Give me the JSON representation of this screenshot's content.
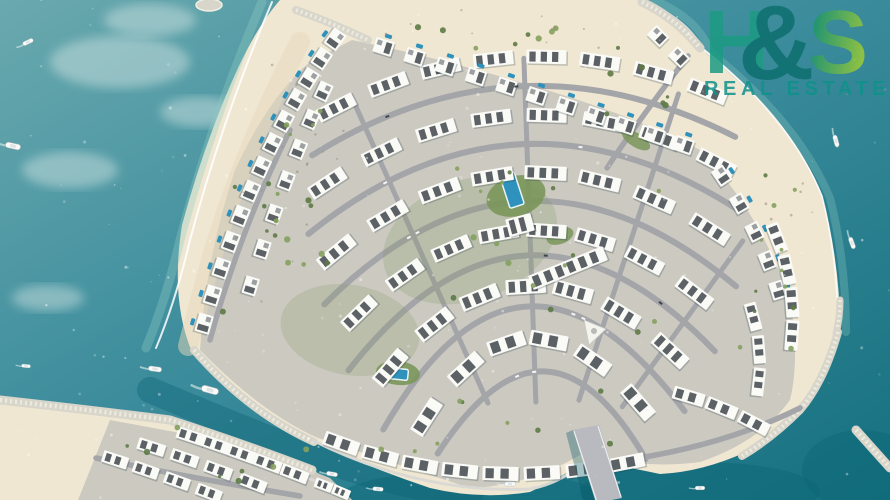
{
  "watermark": {
    "h": "H",
    "amp": "&",
    "s": "S",
    "subtitle": "REAL ESTATE",
    "colors": {
      "h": "#1c9b82",
      "amp": "#0d6f6e",
      "s_from": "#17936c",
      "s_to": "#9ccb37",
      "subtitle": "#0f928a"
    }
  },
  "scene": {
    "w": 890,
    "h": 500,
    "seed": 97,
    "fan_center": [
      540,
      520
    ],
    "colors": {
      "water_top": "#6aa9ae",
      "water_mid": "#3d8d9d",
      "water_deep": "#15707f",
      "channel": "#0c6575",
      "milky": "#e8f2ee",
      "sand": "#f0e7d2",
      "sand_shade": "#e6dabc",
      "pavement": "#cbc9c0",
      "road": "#a4a5a9",
      "promenade": "#d9d8d3",
      "rock": "#d8d5ca",
      "rock_light": "#f1eee4",
      "wall": "#fafaf7",
      "roof": "#3e454a",
      "shadow": "#223a44",
      "pool": "#2f92bc",
      "pool_edge": "#e8f4f6",
      "green_dark": "#5d7a45",
      "green_light": "#85a05e",
      "lawn": "#7b965a",
      "foam": "#ffffff",
      "shallow": "#8ecac3",
      "speck": "#90856f",
      "car_light": "#f5f5f5",
      "car_dark": "#3e454a",
      "boat_hull": "#fbfbf9",
      "boat_deck": "#dfe5e6",
      "boat_edge": "#9fb0b4",
      "wake": "#dff0ee",
      "bridge_deck": "#b9bac0",
      "bridge_rail": "#eceff0",
      "bridge_shadow": "#0a5864",
      "plaza": "#f4f3ee",
      "plaza_edge": "#c9c9c4",
      "plaza_dot": "#b9bab6"
    },
    "deep_ellipses": [
      [
        470,
        497,
        130,
        26
      ],
      [
        700,
        492,
        120,
        30
      ],
      [
        862,
        470,
        60,
        40
      ]
    ],
    "channel_strokes": [
      "M150,390 Q250,432 330,462 Q400,486 470,496"
    ],
    "milky_patches": [
      [
        120,
        62,
        70,
        26
      ],
      [
        70,
        170,
        48,
        18
      ],
      [
        200,
        112,
        40,
        15
      ],
      [
        48,
        298,
        36,
        13
      ],
      [
        150,
        20,
        46,
        16
      ]
    ],
    "landmasses": [
      {
        "name": "south-island-sand",
        "fill": "sand",
        "d": "M0,398 L30,402 Q100,412 170,420 Q240,444 300,464 Q335,480 352,500 L0,500 Z"
      },
      {
        "name": "south-island-pavement",
        "fill": "pavement",
        "d": "M110,420 L250,446 L330,478 L352,500 L78,500 Z"
      },
      {
        "name": "main-island-sand",
        "fill": "sand",
        "d": "M280,0 L645,0 Q680,20 700,46 Q790,115 822,195 Q840,262 840,330 Q828,372 806,404 Q782,430 746,452 Q702,472 660,474 Q622,466 588,460 Q560,478 530,492 Q480,500 430,488 Q370,468 314,442 Q250,414 192,352 Q170,300 182,225 Q205,140 238,68 Q258,25 280,0 Z"
      },
      {
        "name": "main-island-pavement",
        "fill": "pavement",
        "d": "M352,40 Q440,58 540,88 Q640,118 700,150 Q760,212 790,300 Q800,360 790,400 Q760,442 700,462 Q640,470 585,452 Q530,486 470,488 Q390,462 318,438 Q260,412 200,350 Q205,260 235,170 Q270,95 310,62 Z"
      }
    ],
    "beach_shade": {
      "d": "M300,42 Q248,140 214,250 Q200,300 188,346",
      "color": "#e6dabc",
      "wd": 20,
      "op": 0.5
    },
    "foam": [
      {
        "d": "M262,2 Q212,120 180,240 Q166,300 146,348",
        "color": "#8ecac3",
        "wd": 9,
        "op": 0.35
      },
      {
        "d": "M272,2 Q222,120 190,240 Q176,300 156,348",
        "color": "#ffffff",
        "wd": 2,
        "op": 0.85
      },
      {
        "d": "M654,0 Q700,20 710,52 Q798,122 830,198 Q846,262 846,332",
        "color": "#8ecac3",
        "wd": 8,
        "op": 0.3
      },
      {
        "d": "M648,2 Q690,22 702,48 Q790,118 822,196 Q838,260 838,330",
        "color": "#ffffff",
        "wd": 1.6,
        "op": 0.8
      }
    ],
    "rocks": [
      {
        "d": "M296,10 Q330,22 368,40",
        "wd": 8
      },
      {
        "d": "M642,2 Q676,18 700,48",
        "wd": 9
      },
      {
        "d": "M840,300 Q840,318 836,334",
        "wd": 7
      },
      {
        "d": "M838,332 Q824,382 800,410 Q772,438 742,456",
        "wd": 8
      },
      {
        "d": "M856,430 L890,468",
        "wd": 9
      },
      {
        "d": "M194,350 Q248,412 314,442",
        "wd": 8
      },
      {
        "d": "M0,400 Q90,410 170,420 Q250,446 312,470",
        "wd": 9
      }
    ],
    "roads": {
      "rings": [
        [
          430,
          238,
          297
        ],
        [
          368,
          231,
          303
        ],
        [
          305,
          225,
          310
        ],
        [
          243,
          218,
          316
        ],
        [
          181,
          210,
          323
        ],
        [
          122,
          213,
          330
        ]
      ],
      "spokes": [
        [
          246,
          128,
          452
        ],
        [
          268,
          118,
          462
        ],
        [
          288,
          126,
          448
        ],
        [
          306,
          140,
          345
        ]
      ],
      "extra": [
        "M688,56 Q640,118 607,168",
        "M612,462 Q720,448 800,408",
        "M96,458 Q180,476 300,496",
        "M210,340 Q240,230 290,130"
      ]
    },
    "cars": {
      "n": 12
    },
    "promenades": [
      "M312,440 Q420,494 530,489 Q562,483 588,459",
      "M178,430 Q250,455 318,482"
    ],
    "parks": [
      [
        516,
        196,
        30,
        20,
        -15,
        0.9
      ],
      [
        398,
        373,
        22,
        12,
        6,
        0.9
      ],
      [
        636,
        140,
        16,
        7,
        32,
        0.85
      ],
      [
        560,
        236,
        14,
        8,
        -20,
        0.85
      ],
      [
        470,
        240,
        90,
        60,
        -20,
        0.22
      ],
      [
        350,
        330,
        70,
        45,
        10,
        0.2
      ]
    ],
    "pools": [
      [
        512,
        190,
        15,
        34,
        -18
      ],
      [
        398,
        374,
        20,
        11,
        6
      ]
    ],
    "plaza": {
      "tri": "M584,320 L606,329 L589,345 Z",
      "dot": [
        594,
        331,
        3
      ]
    },
    "rows": [
      {
        "kind": "ring",
        "r": 460,
        "a0": 240,
        "a1": 295,
        "count": 8,
        "type": "block",
        "w": 40,
        "h": 14
      },
      {
        "kind": "ring",
        "r": 398,
        "a0": 233,
        "a1": 301,
        "count": 8,
        "type": "block",
        "w": 40,
        "h": 14
      },
      {
        "kind": "ring",
        "r": 336,
        "a0": 227,
        "a1": 306,
        "count": 8,
        "type": "block",
        "w": 42,
        "h": 14
      },
      {
        "kind": "ring",
        "r": 274,
        "a0": 222,
        "a1": 311,
        "count": 8,
        "type": "block",
        "w": 40,
        "h": 14
      },
      {
        "kind": "ring",
        "r": 212,
        "a0": 216,
        "a1": 317,
        "count": 7,
        "type": "block",
        "w": 40,
        "h": 15
      },
      {
        "kind": "ring",
        "r": 150,
        "a0": 208,
        "a1": 324,
        "count": 6,
        "type": "block",
        "w": 38,
        "h": 15
      },
      {
        "kind": "quad",
        "p": [
          342,
          30,
          252,
          150,
          200,
          338
        ],
        "count": 13,
        "type": "villa",
        "w": 19,
        "h": 15,
        "pool": 1
      },
      {
        "kind": "quad",
        "p": [
          330,
          78,
          285,
          170,
          245,
          305
        ],
        "count": 7,
        "type": "villa",
        "w": 18,
        "h": 14,
        "pool": 0
      },
      {
        "kind": "quad",
        "p": [
          368,
          42,
          540,
          96,
          698,
          150
        ],
        "count": 11,
        "type": "villa",
        "w": 19,
        "h": 15,
        "pool": -1
      },
      {
        "kind": "quad",
        "p": [
          712,
          162,
          762,
          230,
          782,
          305
        ],
        "count": 5,
        "type": "villa",
        "w": 18,
        "h": 14,
        "pool": -1
      },
      {
        "kind": "quad",
        "p": [
          648,
          26,
          668,
          46,
          690,
          68
        ],
        "count": 2,
        "type": "villa",
        "w": 18,
        "h": 14,
        "pool": 0
      },
      {
        "kind": "quad",
        "p": [
          322,
          436,
          475,
          498,
          648,
          458
        ],
        "count": 8,
        "type": "block",
        "w": 36,
        "h": 14
      },
      {
        "kind": "quad",
        "p": [
          672,
          392,
          722,
          404,
          770,
          432
        ],
        "count": 3,
        "type": "block",
        "w": 32,
        "h": 13
      },
      {
        "kind": "quad",
        "p": [
          770,
          222,
          800,
          285,
          790,
          352
        ],
        "count": 4,
        "type": "block",
        "w": 30,
        "h": 13
      },
      {
        "kind": "quad",
        "p": [
          748,
          300,
          766,
          350,
          756,
          398
        ],
        "count": 3,
        "type": "block",
        "w": 28,
        "h": 12
      },
      {
        "kind": "quad",
        "p": [
          178,
          432,
          240,
          452,
          308,
          479
        ],
        "count": 5,
        "type": "block",
        "w": 28,
        "h": 12
      },
      {
        "kind": "quad",
        "p": [
          135,
          442,
          200,
          462,
          270,
          490
        ],
        "count": 4,
        "type": "block",
        "w": 28,
        "h": 12
      },
      {
        "kind": "quad",
        "p": [
          100,
          455,
          160,
          474,
          225,
          499
        ],
        "count": 4,
        "type": "block",
        "w": 26,
        "h": 12
      },
      {
        "kind": "quad",
        "p": [
          315,
          482,
          332,
          488,
          350,
          496
        ],
        "count": 2,
        "type": "block",
        "w": 18,
        "h": 10
      }
    ],
    "extra_blocks": [
      [
        568,
        268,
        80,
        15,
        -22,
        6
      ],
      [
        520,
        225,
        26,
        18,
        -15,
        2
      ]
    ],
    "tree_zones": [
      [
        220,
        90,
        110,
        230,
        12
      ],
      [
        360,
        25,
        270,
        35,
        9
      ],
      [
        420,
        150,
        240,
        190,
        16
      ],
      [
        690,
        170,
        110,
        210,
        12
      ],
      [
        380,
        390,
        240,
        70,
        9
      ],
      [
        120,
        425,
        200,
        60,
        8
      ],
      [
        240,
        170,
        80,
        150,
        7
      ],
      [
        600,
        60,
        80,
        60,
        6
      ]
    ],
    "speck_zones": [
      [
        230,
        60,
        120,
        250,
        16
      ],
      [
        380,
        10,
        260,
        40,
        10
      ],
      [
        760,
        120,
        70,
        150,
        8
      ]
    ],
    "boats": [
      [
        28,
        42,
        -25,
        0.8
      ],
      [
        13,
        146,
        12,
        1.1
      ],
      [
        836,
        141,
        75,
        0.85
      ],
      [
        852,
        243,
        70,
        0.85
      ],
      [
        210,
        390,
        15,
        1.25
      ],
      [
        155,
        369,
        8,
        0.95
      ],
      [
        26,
        366,
        5,
        0.65
      ],
      [
        332,
        474,
        10,
        0.8
      ],
      [
        378,
        489,
        5,
        0.75
      ],
      [
        510,
        484,
        0,
        0.8
      ],
      [
        700,
        488,
        0,
        0.7
      ]
    ],
    "bridge": {
      "deck": "M573,430 L599,425 L622,498 L596,503 Z",
      "shadow": "M566,433 L573,430 L596,503 L584,503 Z",
      "rails": [
        "M574,431 L597,502",
        "M598,426 L621,497"
      ]
    },
    "islet": [
      209,
      5,
      13,
      6
    ],
    "sparkles": {
      "n": 190
    }
  }
}
